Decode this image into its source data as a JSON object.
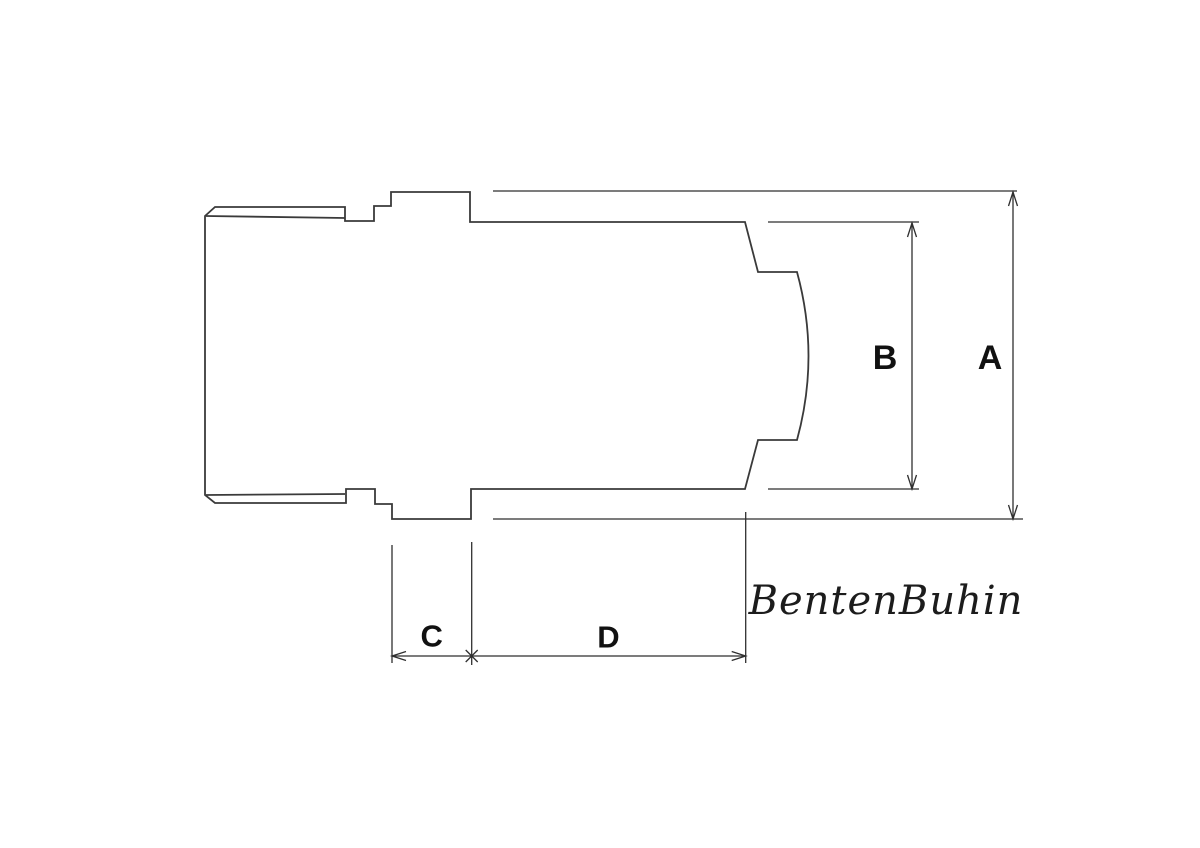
{
  "drawing": {
    "type": "technical-dimension-drawing",
    "watermark": "BentenBuhin",
    "dimensions": {
      "a": "A",
      "b": "B",
      "c": "C",
      "d": "D"
    },
    "colors": {
      "outline": "#3a3a3a",
      "dimension_lines": "#2f2f2f",
      "label_text": "#111111",
      "background": "#ffffff"
    }
  }
}
